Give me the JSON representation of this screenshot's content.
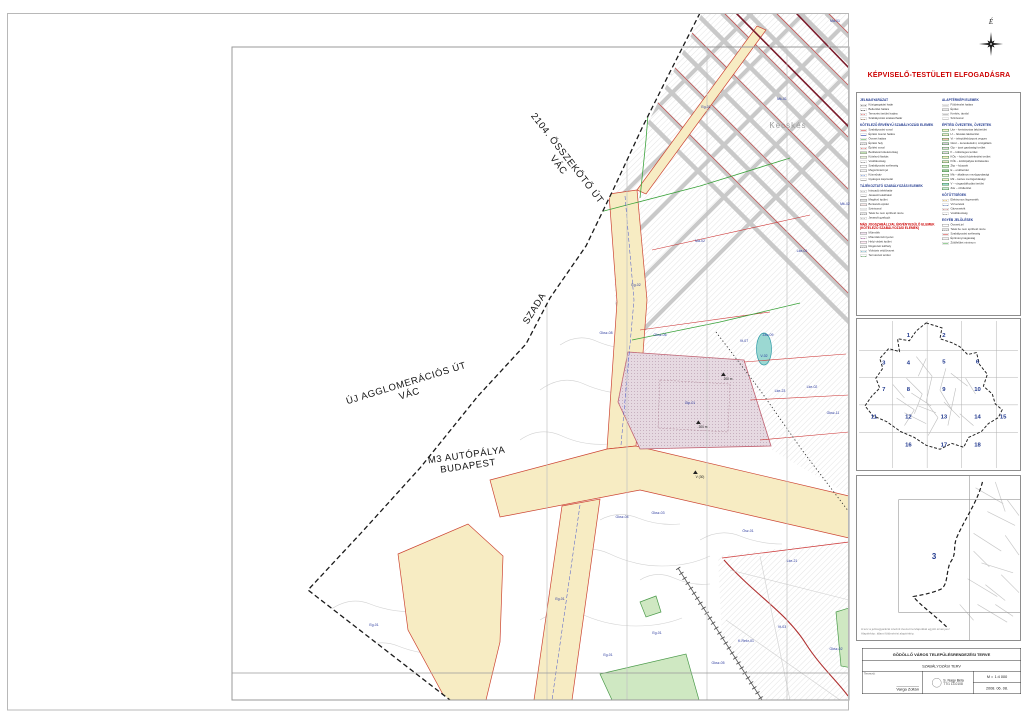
{
  "approval_title": "KÉPVISELŐ-TESTÜLETI ELFOGADÁSRA",
  "compass": {
    "north_label": "É"
  },
  "map": {
    "district_label": {
      "t": "Kecskés",
      "x": 788,
      "y": 128
    },
    "road_labels": [
      {
        "lines": [
          "2104. ÖSSZEKÖTŐ ÚT",
          "VÁC"
        ],
        "x": 565,
        "y": 160,
        "rot": 52,
        "size": 9.5
      },
      {
        "lines": [
          "SZADA"
        ],
        "x": 537,
        "y": 310,
        "rot": -58,
        "size": 9.5
      },
      {
        "lines": [
          "ÚJ AGGLOMERÁCIÓS ÚT",
          "VÁC"
        ],
        "x": 407,
        "y": 386,
        "rot": -17,
        "size": 9.5
      },
      {
        "lines": [
          "M3 AUTÓPÁLYA",
          "BUDAPEST"
        ],
        "x": 467,
        "y": 458,
        "rot": -8,
        "size": 9.5
      }
    ],
    "zone_labels": [
      {
        "t": "Má-01",
        "x": 835,
        "y": 22
      },
      {
        "t": "Mk-01",
        "x": 782,
        "y": 100
      },
      {
        "t": "Eg-01",
        "x": 706,
        "y": 108
      },
      {
        "t": "Mk-02",
        "x": 845,
        "y": 205
      },
      {
        "t": "Lke-01",
        "x": 802,
        "y": 252
      },
      {
        "t": "Má-02",
        "x": 700,
        "y": 242
      },
      {
        "t": "Eg-02",
        "x": 636,
        "y": 286
      },
      {
        "t": "Gksz-08",
        "x": 606,
        "y": 334
      },
      {
        "t": "Gksz-06",
        "x": 660,
        "y": 336
      },
      {
        "t": "Vt-07",
        "x": 744,
        "y": 342
      },
      {
        "t": "Záv-09",
        "x": 768,
        "y": 336
      },
      {
        "t": "V-02",
        "x": 764,
        "y": 357
      },
      {
        "t": "Lke-23",
        "x": 780,
        "y": 392
      },
      {
        "t": "Lke-02",
        "x": 812,
        "y": 388
      },
      {
        "t": "Gip-01",
        "x": 690,
        "y": 404
      },
      {
        "t": "Gksz-11",
        "x": 833,
        "y": 414
      },
      {
        "t": "Gksz-04",
        "x": 622,
        "y": 518
      },
      {
        "t": "Gksz-03",
        "x": 658,
        "y": 514
      },
      {
        "t": "Ösz-01",
        "x": 748,
        "y": 532
      },
      {
        "t": "Lke-21",
        "x": 792,
        "y": 562
      },
      {
        "t": "Eg-01",
        "x": 560,
        "y": 600
      },
      {
        "t": "Eg-01",
        "x": 374,
        "y": 626
      },
      {
        "t": "Eg-01",
        "x": 657,
        "y": 634
      },
      {
        "t": "K-Rekr-01",
        "x": 746,
        "y": 642
      },
      {
        "t": "Gksz-05",
        "x": 718,
        "y": 664
      },
      {
        "t": "Gksz-02",
        "x": 836,
        "y": 650
      },
      {
        "t": "Eg-01",
        "x": 608,
        "y": 656
      },
      {
        "t": "Vt-03",
        "x": 782,
        "y": 628
      }
    ],
    "measure_labels": [
      {
        "t": "200 m",
        "x": 728,
        "y": 380,
        "m": 1
      },
      {
        "t": "200 m",
        "x": 703,
        "y": 428,
        "m": 1
      },
      {
        "t": "V (30)",
        "x": 700,
        "y": 478,
        "m": 2
      }
    ]
  },
  "legend": {
    "columns": [
      {
        "sections": [
          {
            "h": "JELMAGYARÁZAT",
            "rows": [
              {
                "sw": {
                  "k": "line",
                  "c": "#222222",
                  "d": "dashdot"
                },
                "t": "Közigazgatási határ"
              },
              {
                "sw": {
                  "k": "line",
                  "c": "#222222",
                  "d": "dash"
                },
                "t": "Belterület határa"
              },
              {
                "sw": {
                  "k": "line",
                  "c": "#cc2222",
                  "d": "dash"
                },
                "t": "Tervezési terület határa"
              },
              {
                "sw": {
                  "k": "line",
                  "c": "#8a5a2a",
                  "d": "dash"
                },
                "t": "Szabályozási szakaszhatár"
              }
            ]
          },
          {
            "h": "KÖTELEZŐ ÉRVÉNYŰ SZABÁLYOZÁSI ELEMEK",
            "rows": [
              {
                "sw": {
                  "k": "line",
                  "c": "#cc2222",
                  "d": "solid"
                },
                "t": "Szabályozási vonal"
              },
              {
                "sw": {
                  "k": "line",
                  "c": "#2244cc",
                  "d": "solid"
                },
                "t": "Építési övezet határa"
              },
              {
                "sw": {
                  "k": "line",
                  "c": "#33a033",
                  "d": "solid"
                },
                "t": "Övezet határa"
              },
              {
                "sw": {
                  "k": "hatch"
                },
                "t": "Építési hely"
              },
              {
                "sw": {
                  "k": "line",
                  "c": "#cc2222",
                  "d": "dashdot"
                },
                "t": "Építési vonal"
              },
              {
                "sw": {
                  "k": "fill",
                  "c": "#bfe0b0"
                },
                "t": "Beültetési kötelezettség"
              },
              {
                "sw": {
                  "k": "fill",
                  "c": "#e8f0d8"
                },
                "t": "Kötelező fásítás"
              },
              {
                "sw": {
                  "k": "line",
                  "c": "#777777",
                  "d": "dash"
                },
                "t": "Védőtávolság"
              },
              {
                "sw": {
                  "k": "fill",
                  "c": "#ffffff"
                },
                "t": "Szabályozási szélesség"
              },
              {
                "sw": {
                  "k": "fill",
                  "c": "#f4f4f4"
                },
                "t": "Megszüntető jel"
              },
              {
                "sw": {
                  "k": "line",
                  "c": "#3a6acc",
                  "d": "dash"
                },
                "t": "Közműsáv"
              },
              {
                "sw": {
                  "k": "line",
                  "c": "#999999",
                  "d": "solid"
                },
                "t": "Gyalogos kapcsolat"
              }
            ]
          },
          {
            "h": "TÁJÉKOZTATÓ SZABÁLYOZÁSI ELEMEK",
            "rows": [
              {
                "sw": {
                  "k": "line",
                  "c": "#888888",
                  "d": "dash"
                },
                "t": "Irányadó telekhatár"
              },
              {
                "sw": {
                  "k": "line",
                  "c": "#888888",
                  "d": "solid"
                },
                "t": "Javasolt telekhatár"
              },
              {
                "sw": {
                  "k": "fill",
                  "c": "#e0e0e0"
                },
                "t": "Meglévő épület"
              },
              {
                "sw": {
                  "k": "fill",
                  "c": "#f8e8e8"
                },
                "t": "Bontandó épület"
              },
              {
                "sw": {
                  "k": "line",
                  "c": "#cccccc",
                  "d": "solid"
                },
                "t": "Szintvonal"
              },
              {
                "sw": {
                  "k": "hatch"
                },
                "t": "Telek be nem építhető része"
              },
              {
                "sw": {
                  "k": "line",
                  "c": "#888888",
                  "d": "dash"
                },
                "t": "Javasolt gyalogút"
              }
            ]
          },
          {
            "h": "MÁS JOGSZABÁLLYAL ÉRVÉNYESÜLŐ ELEMEK (KÖTELEZŐ SZABÁLYOZÁSI ELEMEK)",
            "red": true,
            "rows": [
              {
                "sw": {
                  "k": "fill",
                  "c": "#f0e0ee"
                },
                "t": "Műemlék"
              },
              {
                "sw": {
                  "k": "line",
                  "c": "#aa44aa",
                  "d": "dash"
                },
                "t": "Műemléki környezet"
              },
              {
                "sw": {
                  "k": "fill",
                  "c": "#ffe8f4"
                },
                "t": "Helyi védett épület"
              },
              {
                "sw": {
                  "k": "hatch"
                },
                "t": "Régészeti lelőhely"
              },
              {
                "sw": {
                  "k": "line",
                  "c": "#2288aa",
                  "d": "dashdot"
                },
                "t": "Vízbázis védőövezet"
              },
              {
                "sw": {
                  "k": "line",
                  "c": "#44aa44",
                  "d": "dashdot"
                },
                "t": "Természeti terület"
              }
            ]
          }
        ]
      },
      {
        "sections": [
          {
            "h": "ALAPTÉRKÉPI ELEMEK",
            "rows": [
              {
                "sw": {
                  "k": "line",
                  "c": "#aaaaaa",
                  "d": "solid"
                },
                "t": "Földrészlet határa"
              },
              {
                "sw": {
                  "k": "fill",
                  "c": "#e8e8e8"
                },
                "t": "Épület"
              },
              {
                "sw": {
                  "k": "line",
                  "c": "#888888",
                  "d": "solid"
                },
                "t": "Kerítés, támfal"
              },
              {
                "sw": {
                  "k": "line",
                  "c": "#cccccc",
                  "d": "solid"
                },
                "t": "Szintvonal"
              }
            ]
          },
          {
            "h": "ÉPÍTÉSI ÖVEZETEK, ÖVEZETEK",
            "rows": [
              {
                "sw": {
                  "k": "zone",
                  "c": "#f8f1cf"
                },
                "t": "Lke – kertvárosias lakóterület"
              },
              {
                "sw": {
                  "k": "zone",
                  "c": "#f3ead0"
                },
                "t": "Lf – falusias lakóterület"
              },
              {
                "sw": {
                  "k": "zone",
                  "c": "#f2c4b4"
                },
                "t": "Vt – településközpont vegyes"
              },
              {
                "sw": {
                  "k": "zone",
                  "c": "#d9c9dd"
                },
                "t": "Gksz – kereskedelmi, szolgáltató"
              },
              {
                "sw": {
                  "k": "zone",
                  "c": "#e6d9e1"
                },
                "t": "Gip – ipari gazdasági terület"
              },
              {
                "sw": {
                  "k": "zone",
                  "c": "#e9d9e9"
                },
                "t": "K – különleges terület"
              },
              {
                "sw": {
                  "k": "zone",
                  "c": "#f7ecc3"
                },
                "t": "KÖu – közúti közlekedési terület"
              },
              {
                "sw": {
                  "k": "zone",
                  "c": "#e8e0c8"
                },
                "t": "KÖk – kötöttpályás közlekedés"
              },
              {
                "sw": {
                  "k": "zone",
                  "c": "#cfe8c2"
                },
                "t": "Zkp – közpark"
              },
              {
                "sw": {
                  "k": "zone",
                  "c": "#9ccc9c"
                },
                "t": "E – erdőterület"
              },
              {
                "sw": {
                  "k": "zone",
                  "c": "#f2f2e2"
                },
                "t": "Má – általános mezőgazdasági"
              },
              {
                "sw": {
                  "k": "zone",
                  "c": "#f8f0d0"
                },
                "t": "Mk – kertes mezőgazdasági"
              },
              {
                "sw": {
                  "k": "zone",
                  "c": "#9bd8d2"
                },
                "t": "V – vízgazdálkodási terület"
              },
              {
                "sw": {
                  "k": "zone",
                  "c": "#cde8d8"
                },
                "t": "Záv – zöldterület"
              }
            ]
          },
          {
            "h": "KÖTÖTTSÉGEK",
            "rows": [
              {
                "sw": {
                  "k": "line",
                  "c": "#cc8800",
                  "d": "dash"
                },
                "t": "Elektromos légvezeték"
              },
              {
                "sw": {
                  "k": "line",
                  "c": "#3a6acc",
                  "d": "dashdot"
                },
                "t": "Vízvezeték"
              },
              {
                "sw": {
                  "k": "line",
                  "c": "#aa3a3a",
                  "d": "dashdot"
                },
                "t": "Gázvezeték"
              },
              {
                "sw": {
                  "k": "line",
                  "c": "#777777",
                  "d": "dash"
                },
                "t": "Védőtávolság"
              }
            ]
          },
          {
            "h": "EGYÉB JELÖLÉSEK",
            "rows": [
              {
                "sw": {
                  "k": "fill",
                  "c": "#ffffff"
                },
                "t": "Övezeti jel"
              },
              {
                "sw": {
                  "k": "hatch"
                },
                "t": "Telek be nem építhető része"
              },
              {
                "sw": {
                  "k": "line",
                  "c": "#cc2222",
                  "d": "solid"
                },
                "t": "Szabályozási szélesség"
              },
              {
                "sw": {
                  "k": "fill",
                  "c": "#f4f4f4"
                },
                "t": "Építménymagasság"
              },
              {
                "sw": {
                  "k": "line",
                  "c": "#33a033",
                  "d": "solid"
                },
                "t": "Zöldfelület minimum"
              }
            ]
          }
        ]
      }
    ]
  },
  "index_map": {
    "numbers": [
      {
        "n": "1",
        "x": 52,
        "y": 18
      },
      {
        "n": "2",
        "x": 88,
        "y": 18
      },
      {
        "n": "3",
        "x": 27,
        "y": 46
      },
      {
        "n": "4",
        "x": 52,
        "y": 46
      },
      {
        "n": "5",
        "x": 88,
        "y": 45
      },
      {
        "n": "6",
        "x": 122,
        "y": 45
      },
      {
        "n": "7",
        "x": 27,
        "y": 73
      },
      {
        "n": "8",
        "x": 52,
        "y": 73
      },
      {
        "n": "9",
        "x": 88,
        "y": 73
      },
      {
        "n": "10",
        "x": 122,
        "y": 73
      },
      {
        "n": "11",
        "x": 17,
        "y": 101
      },
      {
        "n": "12",
        "x": 52,
        "y": 101
      },
      {
        "n": "13",
        "x": 88,
        "y": 101
      },
      {
        "n": "14",
        "x": 122,
        "y": 101
      },
      {
        "n": "15",
        "x": 148,
        "y": 101
      },
      {
        "n": "16",
        "x": 52,
        "y": 129
      },
      {
        "n": "17",
        "x": 88,
        "y": 129
      },
      {
        "n": "18",
        "x": 122,
        "y": 129
      }
    ]
  },
  "locator": {
    "sheet_number": "3",
    "notes": [
      "A terv a jelmagyarázat szerinti övezeti tervlapokkal együtt érvényes!",
      "Alaptérkép: állami földmérési alaptérkép."
    ]
  },
  "titleblock": {
    "line1": "GÖDÖLLŐ VÁROS TELEPÜLÉSRENDEZÉSI TERVE",
    "line2": "SZABÁLYOZÁSI TERV",
    "left_label": "Tervező:",
    "left_name": "Varga Zoltán",
    "mid_line1": "S. Nagy Béla",
    "mid_line2": "TT/1 13-0108",
    "scale_label": "M =",
    "scale_value": "1:4 000",
    "date": "2008. 06. 08."
  }
}
